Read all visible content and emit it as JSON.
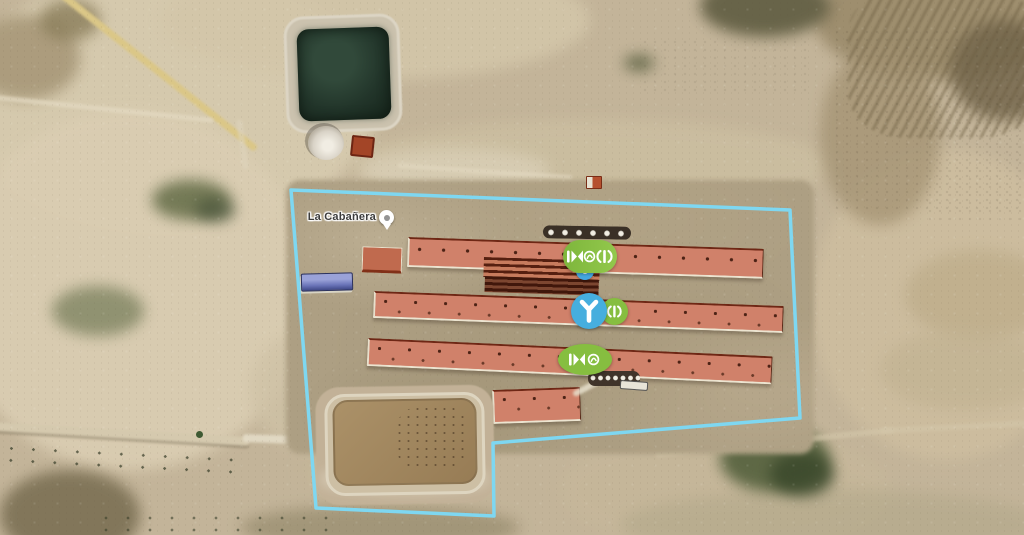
{
  "labels": {
    "place": "La Cabañera"
  },
  "overlay": {
    "boundary": {
      "color": "#7ed7f1",
      "stroke_width": "3.5",
      "points": "291,190 790,210 800,418 493,443 494,516 316,508"
    },
    "markers": [
      {
        "name": "device-cluster-top",
        "shape": "pill",
        "color": "#86be40",
        "badge_color": "#45a7e0",
        "icons": [
          "fan-icon",
          "circulation-fan-icon",
          "airflow-icon"
        ]
      },
      {
        "name": "device-cluster-middle",
        "shape": "two-circles",
        "color_primary": "#46aede",
        "color_secondary": "#86be40",
        "icons": [
          "water-pipe-icon",
          "airflow-icon"
        ]
      },
      {
        "name": "device-cluster-bottom",
        "shape": "ellipse",
        "color": "#86be40",
        "icons": [
          "fan-icon",
          "circulation-fan-icon"
        ]
      }
    ],
    "place_pin": {
      "icon": "place-pin-icon",
      "fill": "#ffffff",
      "dot_color": "#949494"
    }
  },
  "scene_colors": {
    "land_base": "#c3b499",
    "land_light": "#d8ccb0",
    "compound_pad": "#ad9f83",
    "barn_roof": "#d0816a",
    "barn_ridge": "#6e2715",
    "barn_curb": "#ece4d0",
    "feed_stripes_dark": "#551f10",
    "pond_water": "#1d2d22",
    "slurry_lagoon": "#a08762",
    "lagoon_berm": "#c2b197",
    "blue_roof_building": "#6a74b8",
    "sand_road": "#dbc787",
    "vegetation": "#55603c"
  }
}
